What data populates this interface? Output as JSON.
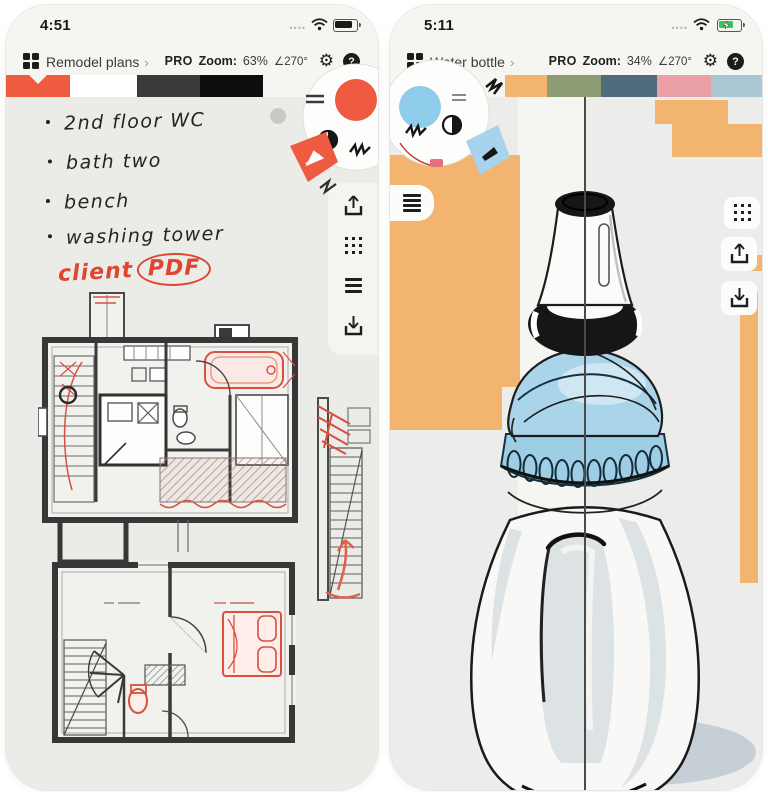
{
  "accents": {
    "red": "#ef5b40",
    "blue": "#8fccea",
    "orange": "#f2b46f",
    "shadow": "#c7cfd6"
  },
  "left_phone": {
    "time": "4:51",
    "toolbar": {
      "title": "Remodel plans",
      "chevron": "›",
      "pro": "PRO",
      "zoom_label": "Zoom:",
      "zoom_value": "63%",
      "rotation": "∠270°",
      "help": "?"
    },
    "palette": [
      "#ef5b40",
      "#ffffff",
      "#3a3a3a",
      "#0d0d0d"
    ],
    "notes": {
      "items": [
        "2nd floor WC",
        "bath two",
        "bench",
        "washing tower"
      ]
    },
    "annotation": {
      "word": "client",
      "circled": "PDF"
    },
    "side_icons": [
      "share",
      "grid",
      "layers",
      "import"
    ]
  },
  "right_phone": {
    "time": "5:11",
    "toolbar": {
      "title": "Water bottle",
      "chevron": "›",
      "pro": "PRO",
      "zoom_label": "Zoom:",
      "zoom_value": "34%",
      "rotation": "∠270°",
      "help": "?"
    },
    "palette": [
      "#f2b46f",
      "#8d9c72",
      "#506c7c",
      "#eb9fa6",
      "#a9c8d4"
    ],
    "side_icons": [
      "grid",
      "share",
      "import"
    ]
  }
}
